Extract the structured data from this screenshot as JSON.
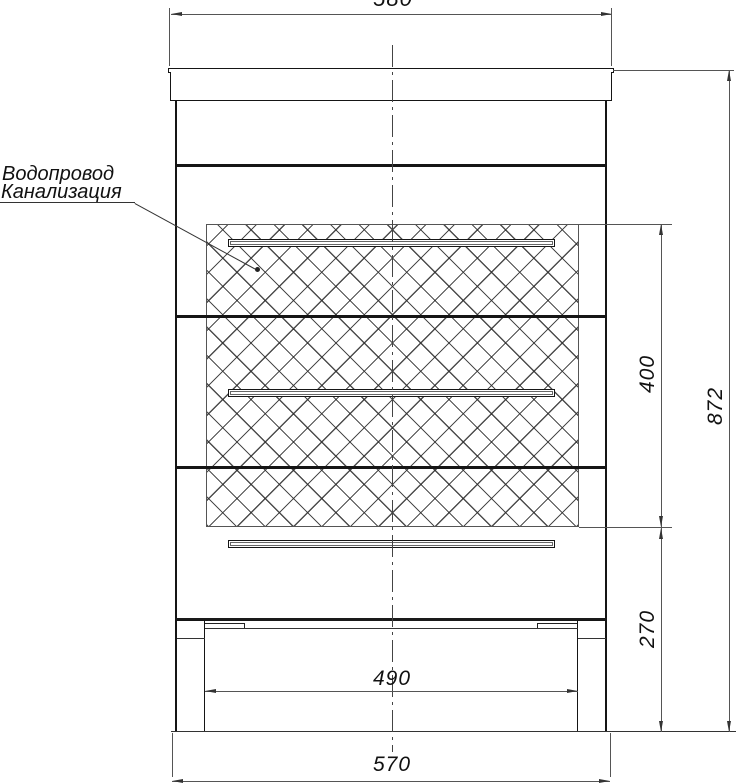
{
  "labels": {
    "plumbing_line1": "Водопровод",
    "plumbing_line2": "Канализация"
  },
  "dimensions": {
    "top_width": "580",
    "overall_height": "872",
    "plumbing_zone_height": "400",
    "bottom_zone_height": "270",
    "inner_base_width": "490",
    "base_width": "570"
  },
  "colors": {
    "outline": "#1a1a1a",
    "dimension_line": "#555555",
    "hatch_line": "#2d2d2d",
    "background": "#ffffff"
  }
}
